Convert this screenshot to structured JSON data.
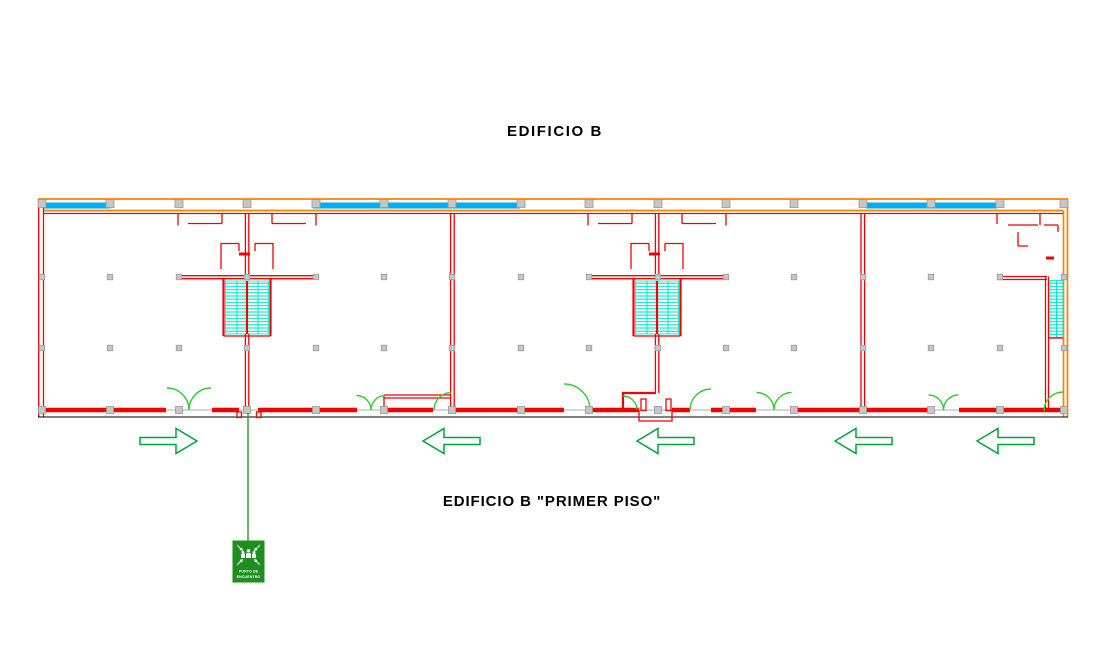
{
  "titles": {
    "top": "EDIFICIO B",
    "bottom": "EDIFICIO B \"PRIMER PISO\""
  },
  "sign": {
    "line1": "PUNTO DE",
    "line2": "ENCUENTRO"
  },
  "arrows": [
    {
      "cx": 168.5,
      "cy": 441,
      "direction": "right"
    },
    {
      "cx": 451.5,
      "cy": 441,
      "direction": "left"
    },
    {
      "cx": 665.5,
      "cy": 441,
      "direction": "left"
    },
    {
      "cx": 863.5,
      "cy": 441,
      "direction": "left"
    },
    {
      "cx": 1005.5,
      "cy": 441,
      "direction": "left"
    }
  ],
  "colors": {
    "wall-red": "#f30000",
    "wall-orange": "#ff8000",
    "window-blue": "#00aeef",
    "stair-cyan": "#00e8c8",
    "door-green": "#33cc33",
    "arrow-green": "#00a33c",
    "sign-green": "#1e8f1e",
    "column-gray": "#c6c6c6",
    "column-border": "#999999",
    "threshold-gray": "#bdbdbd",
    "text-black": "#000000"
  }
}
